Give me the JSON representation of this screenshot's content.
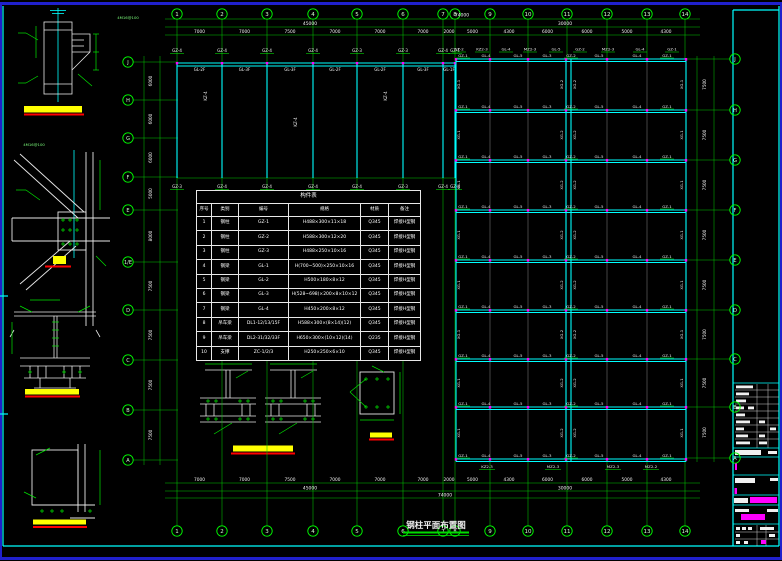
{
  "window": {
    "type": "cad-drawing-canvas"
  },
  "colors": {
    "background": "#000000",
    "frame_cyan": "#00FFFF",
    "window_blue": "#2020CC",
    "grid_green": "#00C800",
    "bubble_green": "#00FF00",
    "member_cyan": "#00FFFF",
    "text_white": "#F0F0F0",
    "highlight_yellow": "#FFFF00",
    "revision_red": "#FF0000",
    "stamp_magenta": "#FF00FF",
    "node_magenta": "#FF00FF",
    "grey_line": "#8A8A8A"
  },
  "drawing_title": {
    "text": "钢柱平面布置图"
  },
  "annotations": {
    "bolt_note": "4M16@100"
  },
  "axes": {
    "top": {
      "labels": [
        "1",
        "2",
        "3",
        "4",
        "5",
        "6",
        "7",
        "8",
        "9",
        "10",
        "11",
        "12",
        "13",
        "14"
      ],
      "x": [
        177,
        222,
        267,
        313,
        357,
        403,
        443,
        455,
        490,
        528,
        567,
        607,
        647,
        685
      ],
      "dims": [
        "7000",
        "7000",
        "7500",
        "7000",
        "7000",
        "7000",
        "2000",
        "5000",
        "4300",
        "6000",
        "6000",
        "5000",
        "4300"
      ]
    },
    "bottom": {
      "labels": [
        "1",
        "2",
        "3",
        "4",
        "5",
        "6",
        "7",
        "8",
        "9",
        "10",
        "11",
        "12",
        "13",
        "14"
      ],
      "dims": [
        "7000",
        "7000",
        "7500",
        "7000",
        "7000",
        "7000",
        "2000",
        "5000",
        "4300",
        "6000",
        "6000",
        "5000",
        "4300"
      ]
    },
    "totals": {
      "grand": "74000",
      "left": "45000",
      "right": "30000"
    },
    "left": {
      "x": 128,
      "labels": [
        "J",
        "H",
        "G",
        "F",
        "E",
        "1/E",
        "D",
        "C",
        "B",
        "A"
      ],
      "y": [
        62,
        100,
        138,
        177,
        210,
        262,
        310,
        360,
        410,
        460
      ],
      "dims": [
        "6000",
        "6000",
        "6000",
        "5000",
        "8000",
        "7500",
        "7500",
        "7500",
        "7500"
      ]
    },
    "right": {
      "x": 735,
      "labels": [
        "J",
        "H",
        "G",
        "F",
        "E",
        "D",
        "C",
        "B",
        "A"
      ],
      "y": [
        59,
        110,
        160,
        210,
        260,
        310,
        359,
        407,
        458
      ],
      "dims": [
        "7500",
        "7500",
        "7500",
        "7500",
        "7500",
        "7500",
        "7500",
        "7500"
      ]
    }
  },
  "left_plan": {
    "cols": [
      177,
      222,
      267,
      313,
      357,
      403,
      443,
      455
    ],
    "top_y": 63,
    "bottom_y": 178,
    "top_labels": [
      "GZ-4",
      "GZ-4",
      "GZ-4",
      "GZ-4",
      "GZ-3",
      "GZ-3",
      "GZ-4",
      "GZ-1"
    ],
    "span_labels": [
      "GL-2F",
      "GL-3F",
      "GL-3F",
      "GL-2F",
      "GL-2F",
      "GL-3F",
      "GL-1F"
    ],
    "mid_labels": [
      {
        "t": "KZ-4",
        "x": 207,
        "y": 96
      },
      {
        "t": "KZ-4",
        "x": 297,
        "y": 122
      },
      {
        "t": "KZ-4",
        "x": 387,
        "y": 96
      }
    ],
    "bottom_labels": [
      "GZ-3",
      "GZ-4",
      "GZ-4",
      "GZ-4",
      "GZ-4",
      "GZ-3",
      "GZ-4",
      "GZ-4"
    ]
  },
  "right_plan": {
    "x0": 456,
    "x1": 686,
    "mid": [
      566,
      571
    ],
    "grey_cols": [
      490,
      528,
      607,
      647
    ],
    "rows": [
      59,
      110,
      160,
      210,
      260,
      310,
      359,
      407,
      459
    ],
    "beam_labels": [
      "GZ-1",
      "GL-4",
      "GL-5",
      "GL-3",
      "GZ-2",
      "GL-5",
      "GL-4",
      "GZ-1"
    ],
    "beam_label_x": [
      463,
      486,
      518,
      547,
      571,
      599,
      637,
      667
    ],
    "bay_labels": [
      "XG-1",
      "XG-2",
      "XG-2",
      "XG-1"
    ],
    "bay_label_x": [
      460,
      563,
      576,
      683
    ],
    "top_labels": [
      "GZ-2",
      "KZ2-3",
      "GL-4",
      "MZ2-3",
      "GL-5",
      "GZ-2",
      "MZ2-3",
      "GL-4",
      "GZ-1"
    ],
    "top_label_x": [
      459,
      482,
      506,
      530,
      556,
      580,
      608,
      640,
      672
    ],
    "bottom_labels": [
      "KZ2-3",
      "MZ2-3",
      "MZ2-3",
      "MZ2-2"
    ],
    "bottom_label_x": [
      487,
      553,
      613,
      651
    ]
  },
  "schedule": {
    "title": "构件表",
    "headers": [
      "序号",
      "类别",
      "编号",
      "规格",
      "材质",
      "备注"
    ],
    "col_widths": [
      15,
      27,
      50,
      72,
      28,
      32
    ],
    "rows": [
      [
        "1",
        "钢柱",
        "GZ-1",
        "H488×300×11×18",
        "Q345",
        "焊接H型钢"
      ],
      [
        "2",
        "钢柱",
        "GZ-2",
        "H588×300×12×20",
        "Q345",
        "焊接H型钢"
      ],
      [
        "3",
        "钢柱",
        "GZ-3",
        "H488×250×10×16",
        "Q345",
        "焊接H型钢"
      ],
      [
        "4",
        "钢梁",
        "GL-1",
        "H(700~500)×250×10×16",
        "Q345",
        "焊接H型钢"
      ],
      [
        "5",
        "钢梁",
        "GL-2",
        "H500×180×8×12",
        "Q345",
        "焊接H型钢"
      ],
      [
        "6",
        "钢梁",
        "GL-3",
        "H(528~698)×200×8×10×12",
        "Q345",
        "焊接H型钢"
      ],
      [
        "7",
        "钢梁",
        "GL-4",
        "H450×200×8×12",
        "Q345",
        "焊接H型钢"
      ],
      [
        "8",
        "吊车梁",
        "DL1-12/13/15F",
        "H588×300×(8×14)(12)",
        "Q345",
        "焊接H型钢"
      ],
      [
        "9",
        "吊车梁",
        "DL2-31/32/33F",
        "H650×300×(10×12)(14)",
        "Q235",
        "焊接H型钢"
      ],
      [
        "10",
        "支撑",
        "ZC-1/2/3",
        "H250×250×6×10",
        "Q345",
        "焊接H型钢"
      ]
    ]
  }
}
